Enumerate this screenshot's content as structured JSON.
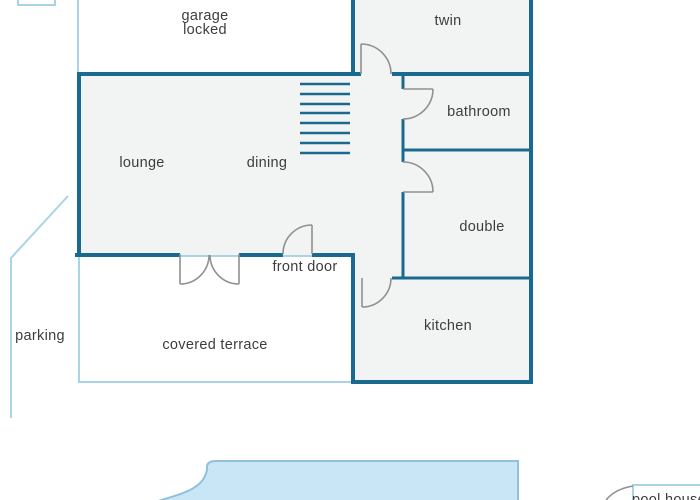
{
  "title": "house floor plan",
  "colors": {
    "wall": "#1a6a8f",
    "light": "#a9d4e8",
    "door": "#909090",
    "room": "#f2f4f4",
    "text": "#3d3d3d",
    "poolFill": "#c9e6f7",
    "poolStroke": "#8fc0dc"
  },
  "labels": {
    "garage_line1": "garage",
    "garage_line2": "locked",
    "twin": "twin",
    "bathroom": "bathroom",
    "double": "double",
    "kitchen": "kitchen",
    "lounge": "lounge",
    "dining": "dining",
    "front_door": "front door",
    "covered_terrace": "covered terrace",
    "parking": "parking",
    "pool_house": "pool house"
  }
}
